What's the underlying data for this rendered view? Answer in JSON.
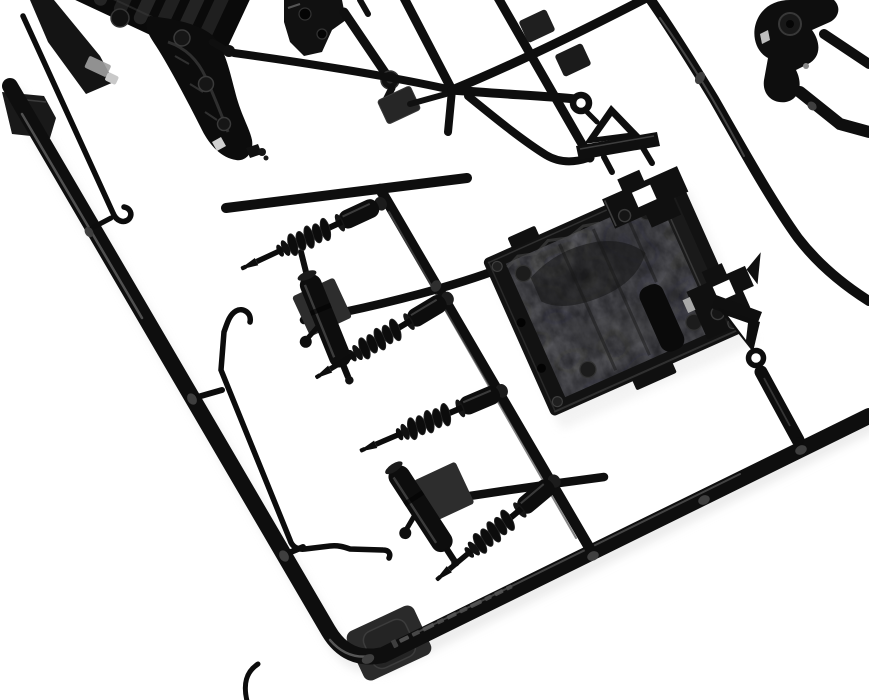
{
  "scene": {
    "type": "product-photo",
    "description": "Close-up photo of a black injection-molded plastic model-kit sprue (parts tree) on a white background. Diagonal runner rails hold an engine and gearbox half, suspension arm brackets, a steering knuckle, four coil-over shock absorbers, two smooth damper cylinders, two bent sway-bar rods, two A-shaped eyelet hanger brackets, stepped mounting brackets and a large rough-textured floor panel. An illegible raised part-number marking is molded into the bottom rail.",
    "background_color": "#ffffff"
  },
  "colors": {
    "plastic": "#0e0e0e",
    "plastic_deep": "#050505",
    "plastic_soft": "#232323",
    "tab_gray": "#2a2a2a",
    "sheen": "#4d4d4d",
    "glint": "#e0e0e0",
    "metal_glint": "#a8a8a8",
    "shadow": "#e0e0e0"
  },
  "parts": {
    "frame_runner": "sprue frame rail",
    "engine_gearbox": "ribbed engine and gearbox half",
    "suspension_arms": "suspension arm brackets",
    "steering_knuckle": "steering knuckle arm",
    "floor_panel": "rough-textured floor panel with bordered frame",
    "stepped_brackets": "stepped castle mounting brackets",
    "triangle_brackets": "A-shaped hanger brackets with eyelet rings",
    "coil_shocks": "coil-over shock absorbers",
    "coil_shock_count": 4,
    "dampers": "smooth damper cylinders",
    "damper_count": 2,
    "sway_bars": "bent sway-bar rods with hooked ends",
    "sway_bar_count": 2,
    "gate_tabs": "flat molding gate tabs",
    "molded_marking": "illegible raised part-number marking on bottom rail"
  }
}
